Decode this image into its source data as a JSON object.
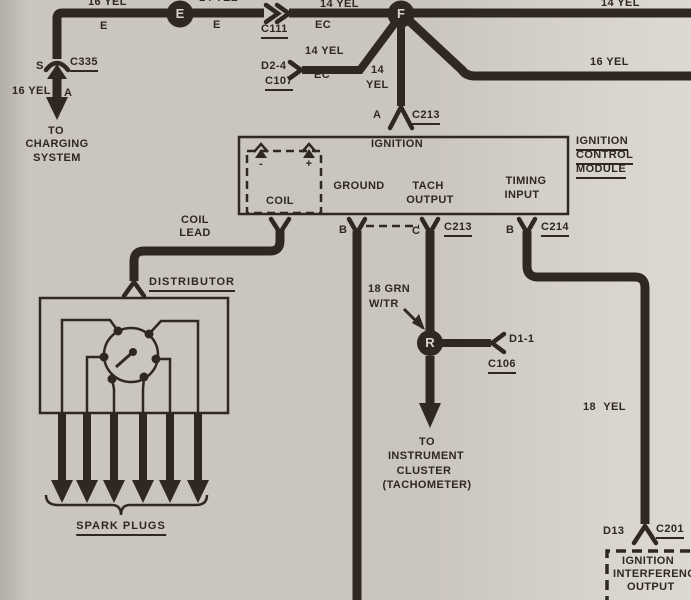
{
  "colors": {
    "ink": "#2e2821",
    "paper": "#cac5bd",
    "paper_light": "#d9d5cd",
    "paper_dark": "#b2ada5",
    "circle_text": "#d8d3cb"
  },
  "feed": {
    "gauge_top_left": "16 YEL",
    "term_e_left": "E",
    "junction_e": "E",
    "gauge_top_cut": "14 YEL",
    "term_e_right": "E",
    "conn_c111": "C111",
    "term_ec": "EC",
    "gauge_mid": "14 YEL",
    "junction_f": "F",
    "gauge_top_right": "14 YEL",
    "gauge_right": "16 YEL"
  },
  "charging": {
    "term_s": "S",
    "conn": "C335",
    "gauge": "16 YEL",
    "term_a": "A",
    "dest": [
      "TO",
      "CHARGING",
      "SYSTEM"
    ]
  },
  "bypass": {
    "term": "D2-4",
    "conn": "C107",
    "gauge": "14 YEL",
    "term_ec": "EC"
  },
  "module_feed": {
    "gauge": [
      "14",
      "YEL"
    ],
    "term_a": "A",
    "conn": "C213"
  },
  "module": {
    "title": "IGNITION",
    "name": [
      "IGNITION",
      "CONTROL",
      "MODULE"
    ],
    "coil": {
      "label": "COIL",
      "minus": "-",
      "plus": "+"
    },
    "pins": {
      "ground": "GROUND",
      "tach": [
        "TACH",
        "OUTPUT"
      ],
      "timing": [
        "TIMING",
        "INPUT"
      ]
    }
  },
  "ground": {
    "term": "B"
  },
  "tach": {
    "term": "C",
    "conn": "C213",
    "wire_color": [
      "18 GRN",
      "W/TR"
    ],
    "junction_r": "R",
    "term_out": "D1-1",
    "conn_out": "C106",
    "dest": [
      "TO",
      "INSTRUMENT",
      "CLUSTER",
      "(TACHOMETER)"
    ]
  },
  "timing": {
    "term": "B",
    "conn": "C214",
    "gauge": "18 YEL",
    "term_out": "D13",
    "conn_out": "C201",
    "box": [
      "IGNITION",
      "INTERFERENCE",
      "OUTPUT"
    ]
  },
  "distributor": {
    "coil_lead": [
      "COIL",
      "LEAD"
    ],
    "label": "DISTRIBUTOR",
    "spark_plugs": "SPARK PLUGS"
  }
}
